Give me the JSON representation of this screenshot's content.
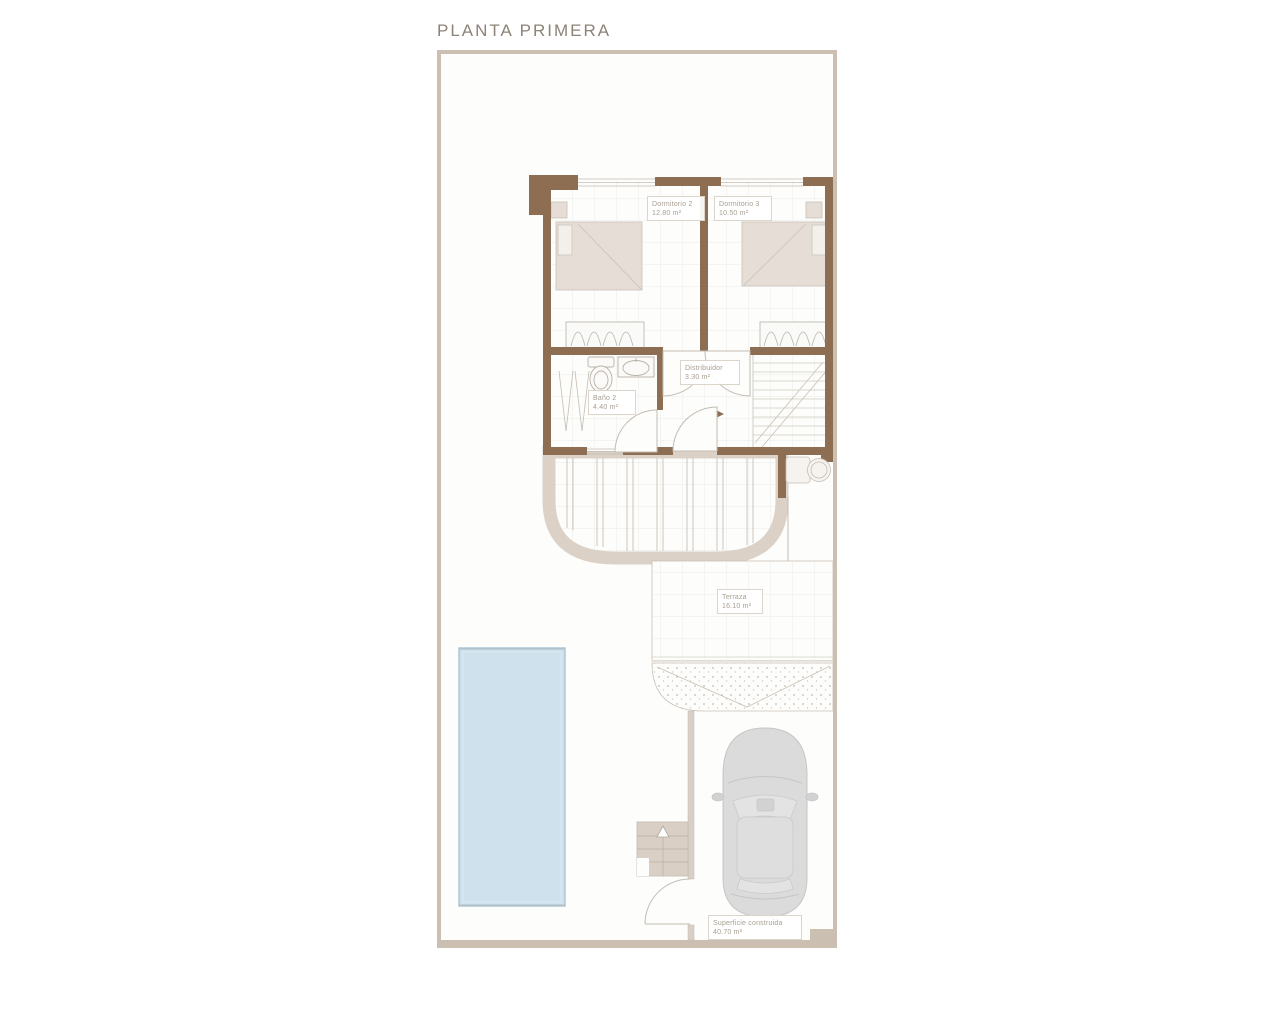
{
  "title": "PLANTA PRIMERA",
  "rooms": [
    {
      "name": "Dormitorio 2",
      "area": "12.80 m²"
    },
    {
      "name": "Dormitorio 3",
      "area": "10.50 m²"
    },
    {
      "name": "Distribuidor",
      "area": "3.30 m²"
    },
    {
      "name": "Baño 2",
      "area": "4.40 m²"
    },
    {
      "name": "Terraza",
      "area": "16.10 m²"
    },
    {
      "name": "Superficie construida",
      "area": "40.70 m²"
    }
  ],
  "colors": {
    "wall_brown": "#8d6e53",
    "frame_tan": "#cbbfb2",
    "railing_beige": "#dbd1c6",
    "stairs_fill": "#d9cfc4",
    "furniture_beige": "#e6ded6",
    "pool_fill": "#cfe1ec",
    "pool_border": "#aec6d5",
    "car_gray": "#dbdbdb",
    "label_text": "#a89e92",
    "title_text": "#8c8276"
  }
}
